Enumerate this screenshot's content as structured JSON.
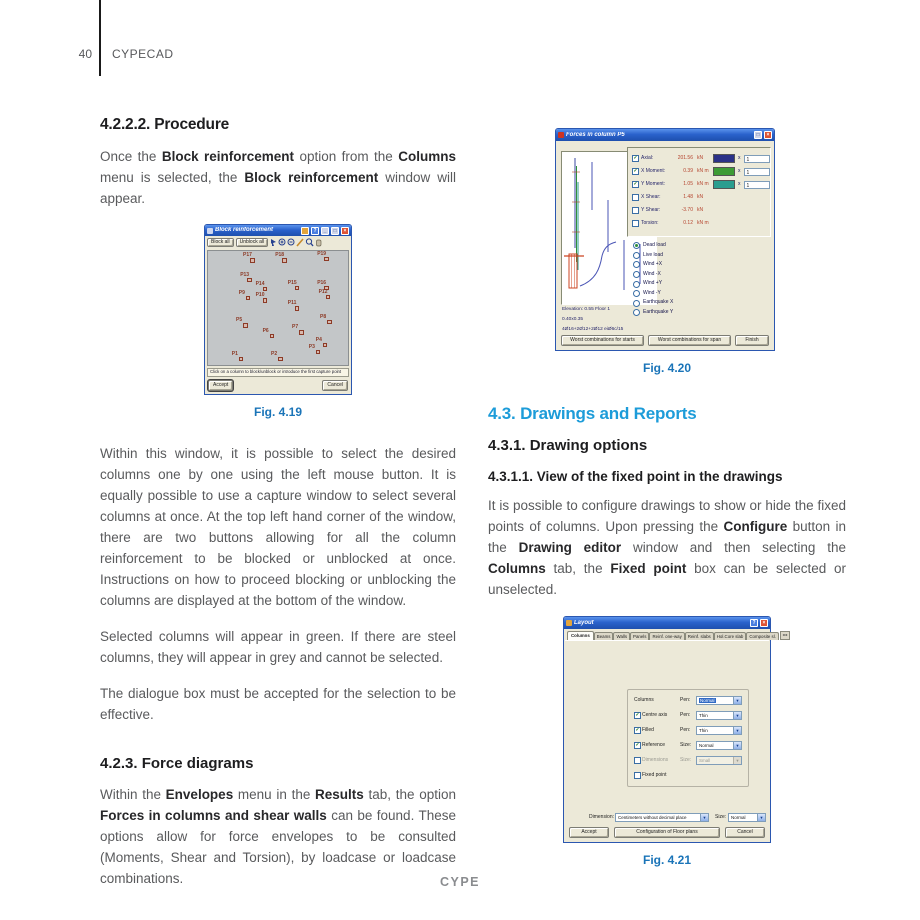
{
  "page": {
    "number": "40",
    "brand": "CYPECAD",
    "footer": "CYPE"
  },
  "left": {
    "h_procedure": "4.2.2.2. Procedure",
    "p1": [
      {
        "t": "Once the ",
        "b": 0
      },
      {
        "t": "Block reinforcement",
        "b": 1
      },
      {
        "t": " option from the ",
        "b": 0
      },
      {
        "t": "Columns",
        "b": 1
      },
      {
        "t": " menu is selected, the ",
        "b": 0
      },
      {
        "t": "Block reinforcement",
        "b": 1
      },
      {
        "t": " window will appear.",
        "b": 0
      }
    ],
    "p2": [
      {
        "t": "Within this window, it is possible to select the desired columns one by one using the left mouse button. It is equally possible to use a capture window to select several columns at once. At the top left hand corner of the window, there are two buttons allowing for all the column reinforcement to be blocked or unblocked at once. Instructions on how to proceed blocking or unblocking the columns are displayed at the bottom of the window.",
        "b": 0
      }
    ],
    "p3": [
      {
        "t": "Selected columns will appear in green. If there are steel columns, they will appear in grey and cannot be selected.",
        "b": 0
      }
    ],
    "p4": [
      {
        "t": "The dialogue box must be accepted for the selection to be effective.",
        "b": 0
      }
    ],
    "h_force": "4.2.3. Force diagrams",
    "p5": [
      {
        "t": "Within the ",
        "b": 0
      },
      {
        "t": "Envelopes",
        "b": 1
      },
      {
        "t": " menu in the ",
        "b": 0
      },
      {
        "t": "Results",
        "b": 1
      },
      {
        "t": " tab, the option ",
        "b": 0
      },
      {
        "t": "Forces in columns and shear walls",
        "b": 1
      },
      {
        "t": " can be found. These options allow for force envelopes to be consulted (Moments, Shear and Torsion), by loadcase or loadcase combinations.",
        "b": 0
      }
    ]
  },
  "right": {
    "h_drawings": "4.3. Drawings and Reports",
    "h_options": "4.3.1. Drawing options",
    "h_fixed": "4.3.1.1. View of the fixed point in the drawings",
    "p1": [
      {
        "t": "It is possible to configure drawings to show or hide the fixed points of columns. Upon pressing the ",
        "b": 0
      },
      {
        "t": "Configure",
        "b": 1
      },
      {
        "t": " button in the ",
        "b": 0
      },
      {
        "t": "Drawing editor",
        "b": 1
      },
      {
        "t": " window and then selecting the ",
        "b": 0
      },
      {
        "t": "Columns",
        "b": 1
      },
      {
        "t": " tab, the ",
        "b": 0
      },
      {
        "t": "Fixed point",
        "b": 1
      },
      {
        "t": " box can be selected or unselected.",
        "b": 0
      }
    ]
  },
  "fig419": {
    "caption": "Fig. 4.19",
    "title": "Block reinforcement",
    "toolbar": {
      "block_all": "Block all",
      "unblock_all": "Unblock all"
    },
    "status": "Click on a column to block/unblock or introduce the first capture point",
    "accept": "Accept",
    "cancel": "Cancel",
    "points": [
      {
        "l": "P17",
        "x": 25,
        "y": 2
      },
      {
        "l": "P18",
        "x": 48,
        "y": 2
      },
      {
        "l": "P19",
        "x": 78,
        "y": 1
      },
      {
        "l": "P13",
        "x": 23,
        "y": 19
      },
      {
        "l": "P14",
        "x": 34,
        "y": 27
      },
      {
        "l": "P15",
        "x": 57,
        "y": 26
      },
      {
        "l": "P16",
        "x": 78,
        "y": 26
      },
      {
        "l": "P9",
        "x": 22,
        "y": 35
      },
      {
        "l": "P10",
        "x": 34,
        "y": 37
      },
      {
        "l": "P12",
        "x": 79,
        "y": 34
      },
      {
        "l": "P11",
        "x": 57,
        "y": 44
      },
      {
        "l": "P5",
        "x": 20,
        "y": 59
      },
      {
        "l": "P8",
        "x": 80,
        "y": 56
      },
      {
        "l": "P7",
        "x": 60,
        "y": 65
      },
      {
        "l": "P6",
        "x": 39,
        "y": 68
      },
      {
        "l": "P4",
        "x": 77,
        "y": 76
      },
      {
        "l": "P3",
        "x": 72,
        "y": 82
      },
      {
        "l": "P1",
        "x": 17,
        "y": 88
      },
      {
        "l": "P2",
        "x": 45,
        "y": 88
      }
    ]
  },
  "fig420": {
    "caption": "Fig. 4.20",
    "title": "Forces in column P5",
    "forces": [
      {
        "label": "Axial:",
        "value": "201.56",
        "unit": "kN",
        "checked": true,
        "color": "#2b3188",
        "factor": "1"
      },
      {
        "label": "X Moment:",
        "value": "0.39",
        "unit": "kN m",
        "checked": true,
        "color": "#3d9b35",
        "factor": "1"
      },
      {
        "label": "Y Moment:",
        "value": "1.05",
        "unit": "kN m",
        "checked": true,
        "color": "#2a9d8f",
        "factor": "1"
      },
      {
        "label": "X Shear:",
        "value": "1.48",
        "unit": "kN",
        "checked": false
      },
      {
        "label": "Y Shear:",
        "value": "-3.70",
        "unit": "kN",
        "checked": false
      },
      {
        "label": "Torsion:",
        "value": "0.12",
        "unit": "kN m",
        "checked": false
      }
    ],
    "multiply_sign": "x",
    "loadcases": [
      {
        "label": "Dead load",
        "selected": true
      },
      {
        "label": "Live load",
        "selected": false
      },
      {
        "label": "Wind +X",
        "selected": false
      },
      {
        "label": "Wind -X",
        "selected": false
      },
      {
        "label": "Wind +Y",
        "selected": false
      },
      {
        "label": "Wind -Y",
        "selected": false
      },
      {
        "label": "Earthquake X",
        "selected": false
      },
      {
        "label": "Earthquake Y",
        "selected": false
      }
    ],
    "info": [
      "Elevation: 0.55 Floor 1",
      "0.40x0.35",
      "4Ø16+2Ø12+2Ø12 eiØ6c/15"
    ],
    "buttons": {
      "starts": "Worst combinations for starts",
      "span": "Worst combinations for span",
      "finish": "Finish"
    }
  },
  "fig421": {
    "caption": "Fig. 4.21",
    "title": "Layout",
    "tabs": [
      "Columns",
      "Beams",
      "Walls",
      "Panels",
      "Reinf. one-way",
      "Reinf. slabs",
      "Hol.Core slab",
      "Composite sl."
    ],
    "tab_scroll": "◂ ▸",
    "options": [
      {
        "label": "Columns",
        "param": "Pen:",
        "value": "Normal",
        "hl": true
      },
      {
        "cb": true,
        "label": "Centre axis",
        "param": "Pen:",
        "value": "Thin"
      },
      {
        "cb": true,
        "label": "Filled",
        "param": "Pen:",
        "value": "Thin"
      },
      {
        "cb": true,
        "label": "Reference",
        "param": "Size:",
        "value": "Normal"
      },
      {
        "cb": false,
        "label": "Dimensions",
        "param": "Size:",
        "value": "Small",
        "dis": true
      },
      {
        "cb": false,
        "label": "Fixed point"
      }
    ],
    "bottom": {
      "dim_label": "Dimension:",
      "dim_value": "Centimeters without decimal place",
      "size_label": "Size:",
      "size_value": "Normal"
    },
    "buttons": {
      "accept": "Accept",
      "config": "Configuration of Floor plans",
      "cancel": "Cancel"
    }
  }
}
